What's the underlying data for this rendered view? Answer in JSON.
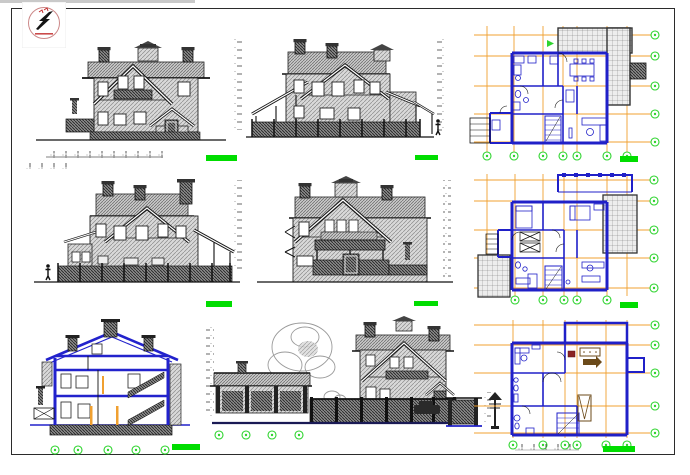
{
  "palette": {
    "paper": "#ffffff",
    "ink": "#1f1f1f",
    "plan_wall_blue": "#2020c8",
    "section_blue": "#2222cc",
    "grid_orange": "#f0a030",
    "axis_marker_green": "#2fd42f",
    "scale_bar_green": "#00dd00",
    "hatch_gray": "#8a8a8a",
    "terrace_gray": "#777777",
    "tree_gray": "#9a9a9a",
    "logo_black": "#141414",
    "logo_red": "#c22a2a",
    "sheet_border": "#2b2b2b"
  },
  "sheet": {
    "width_px": 690,
    "height_px": 475,
    "border_color": "#2b2b2b"
  },
  "logo": {
    "name": "designer-stamp-logo",
    "glyph": "s-lightning-monogram"
  },
  "panels": {
    "p1": {
      "name": "front-elevation",
      "type": "elevation",
      "scale_bars": 1,
      "dimension_lines": 1
    },
    "p2": {
      "name": "side-elevation-right",
      "type": "elevation",
      "level_mark_columns": 2,
      "human_figures": 1
    },
    "p3": {
      "name": "floor-plan-ground",
      "type": "floor-plan",
      "axis_bubbles_bottom": 7,
      "axis_bubbles_right": 5,
      "scale_bars": 1
    },
    "p4": {
      "name": "side-elevation-left",
      "type": "elevation",
      "level_mark_columns": 1,
      "human_figures": 1
    },
    "p5": {
      "name": "rear-elevation",
      "type": "elevation",
      "level_mark_columns": 1
    },
    "p6": {
      "name": "floor-plan-first",
      "type": "floor-plan",
      "axis_bubbles_bottom": 5,
      "axis_bubbles_right": 5,
      "scale_bars": 1
    },
    "p7": {
      "name": "cross-section",
      "type": "section",
      "axis_bubbles_bottom": 5,
      "level_mark_columns": 1,
      "scale_bars": 1
    },
    "p8": {
      "name": "yard-elevation-garage-fence",
      "type": "elevation",
      "axis_bubbles_bottom": 4,
      "trees": 1
    },
    "p9": {
      "name": "floor-plan-attic",
      "type": "floor-plan",
      "axis_bubbles_bottom": 6,
      "axis_bubbles_right": 5,
      "scale_bars": 1
    }
  }
}
